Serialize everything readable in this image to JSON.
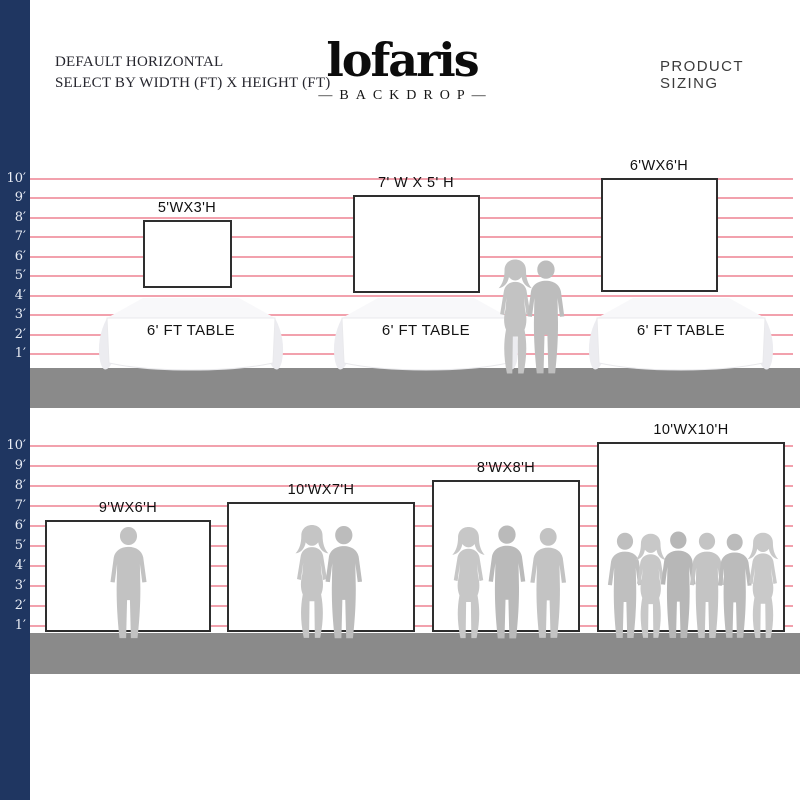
{
  "header": {
    "left_line1": "DEFAULT HORIZONTAL",
    "left_line2": "SELECT BY WIDTH (FT) X HEIGHT (FT)",
    "logo_text": "lofaris",
    "logo_subtext": "—BACKDROP—",
    "right_title": "PRODUCT SIZING"
  },
  "colors": {
    "ruler_bar": "#1f3661",
    "gridline": "#f0919f",
    "ground": "#8a8a8a",
    "backdrop_border": "#2e2e2e",
    "silhouette": "#c1c1c1"
  },
  "ruler": {
    "top_labels": [
      "10′",
      "9′",
      "8′",
      "7′",
      "6′",
      "5′",
      "4′",
      "3′",
      "2′",
      "1′"
    ],
    "bottom_labels": [
      "10′",
      "9′",
      "8′",
      "7′",
      "6′",
      "5′",
      "4′",
      "3′",
      "2′",
      "1′"
    ]
  },
  "table_section": {
    "items": [
      {
        "label": "5'WX3'H",
        "width_ft": 5,
        "height_ft": 3,
        "table_label": "6' FT TABLE"
      },
      {
        "label": "7' W X 5' H",
        "width_ft": 7,
        "height_ft": 5,
        "table_label": "6' FT TABLE"
      },
      {
        "label": "6'WX6'H",
        "width_ft": 6,
        "height_ft": 6,
        "table_label": "6' FT TABLE"
      }
    ]
  },
  "standing_section": {
    "items": [
      {
        "label": "9'WX6'H",
        "width_ft": 9,
        "height_ft": 6,
        "people_count": 1
      },
      {
        "label": "10'WX7'H",
        "width_ft": 10,
        "height_ft": 7,
        "people_count": 2
      },
      {
        "label": "8'WX8'H",
        "width_ft": 8,
        "height_ft": 8,
        "people_count": 3
      },
      {
        "label": "10'WX10'H",
        "width_ft": 10,
        "height_ft": 10,
        "people_count": 6
      }
    ]
  }
}
